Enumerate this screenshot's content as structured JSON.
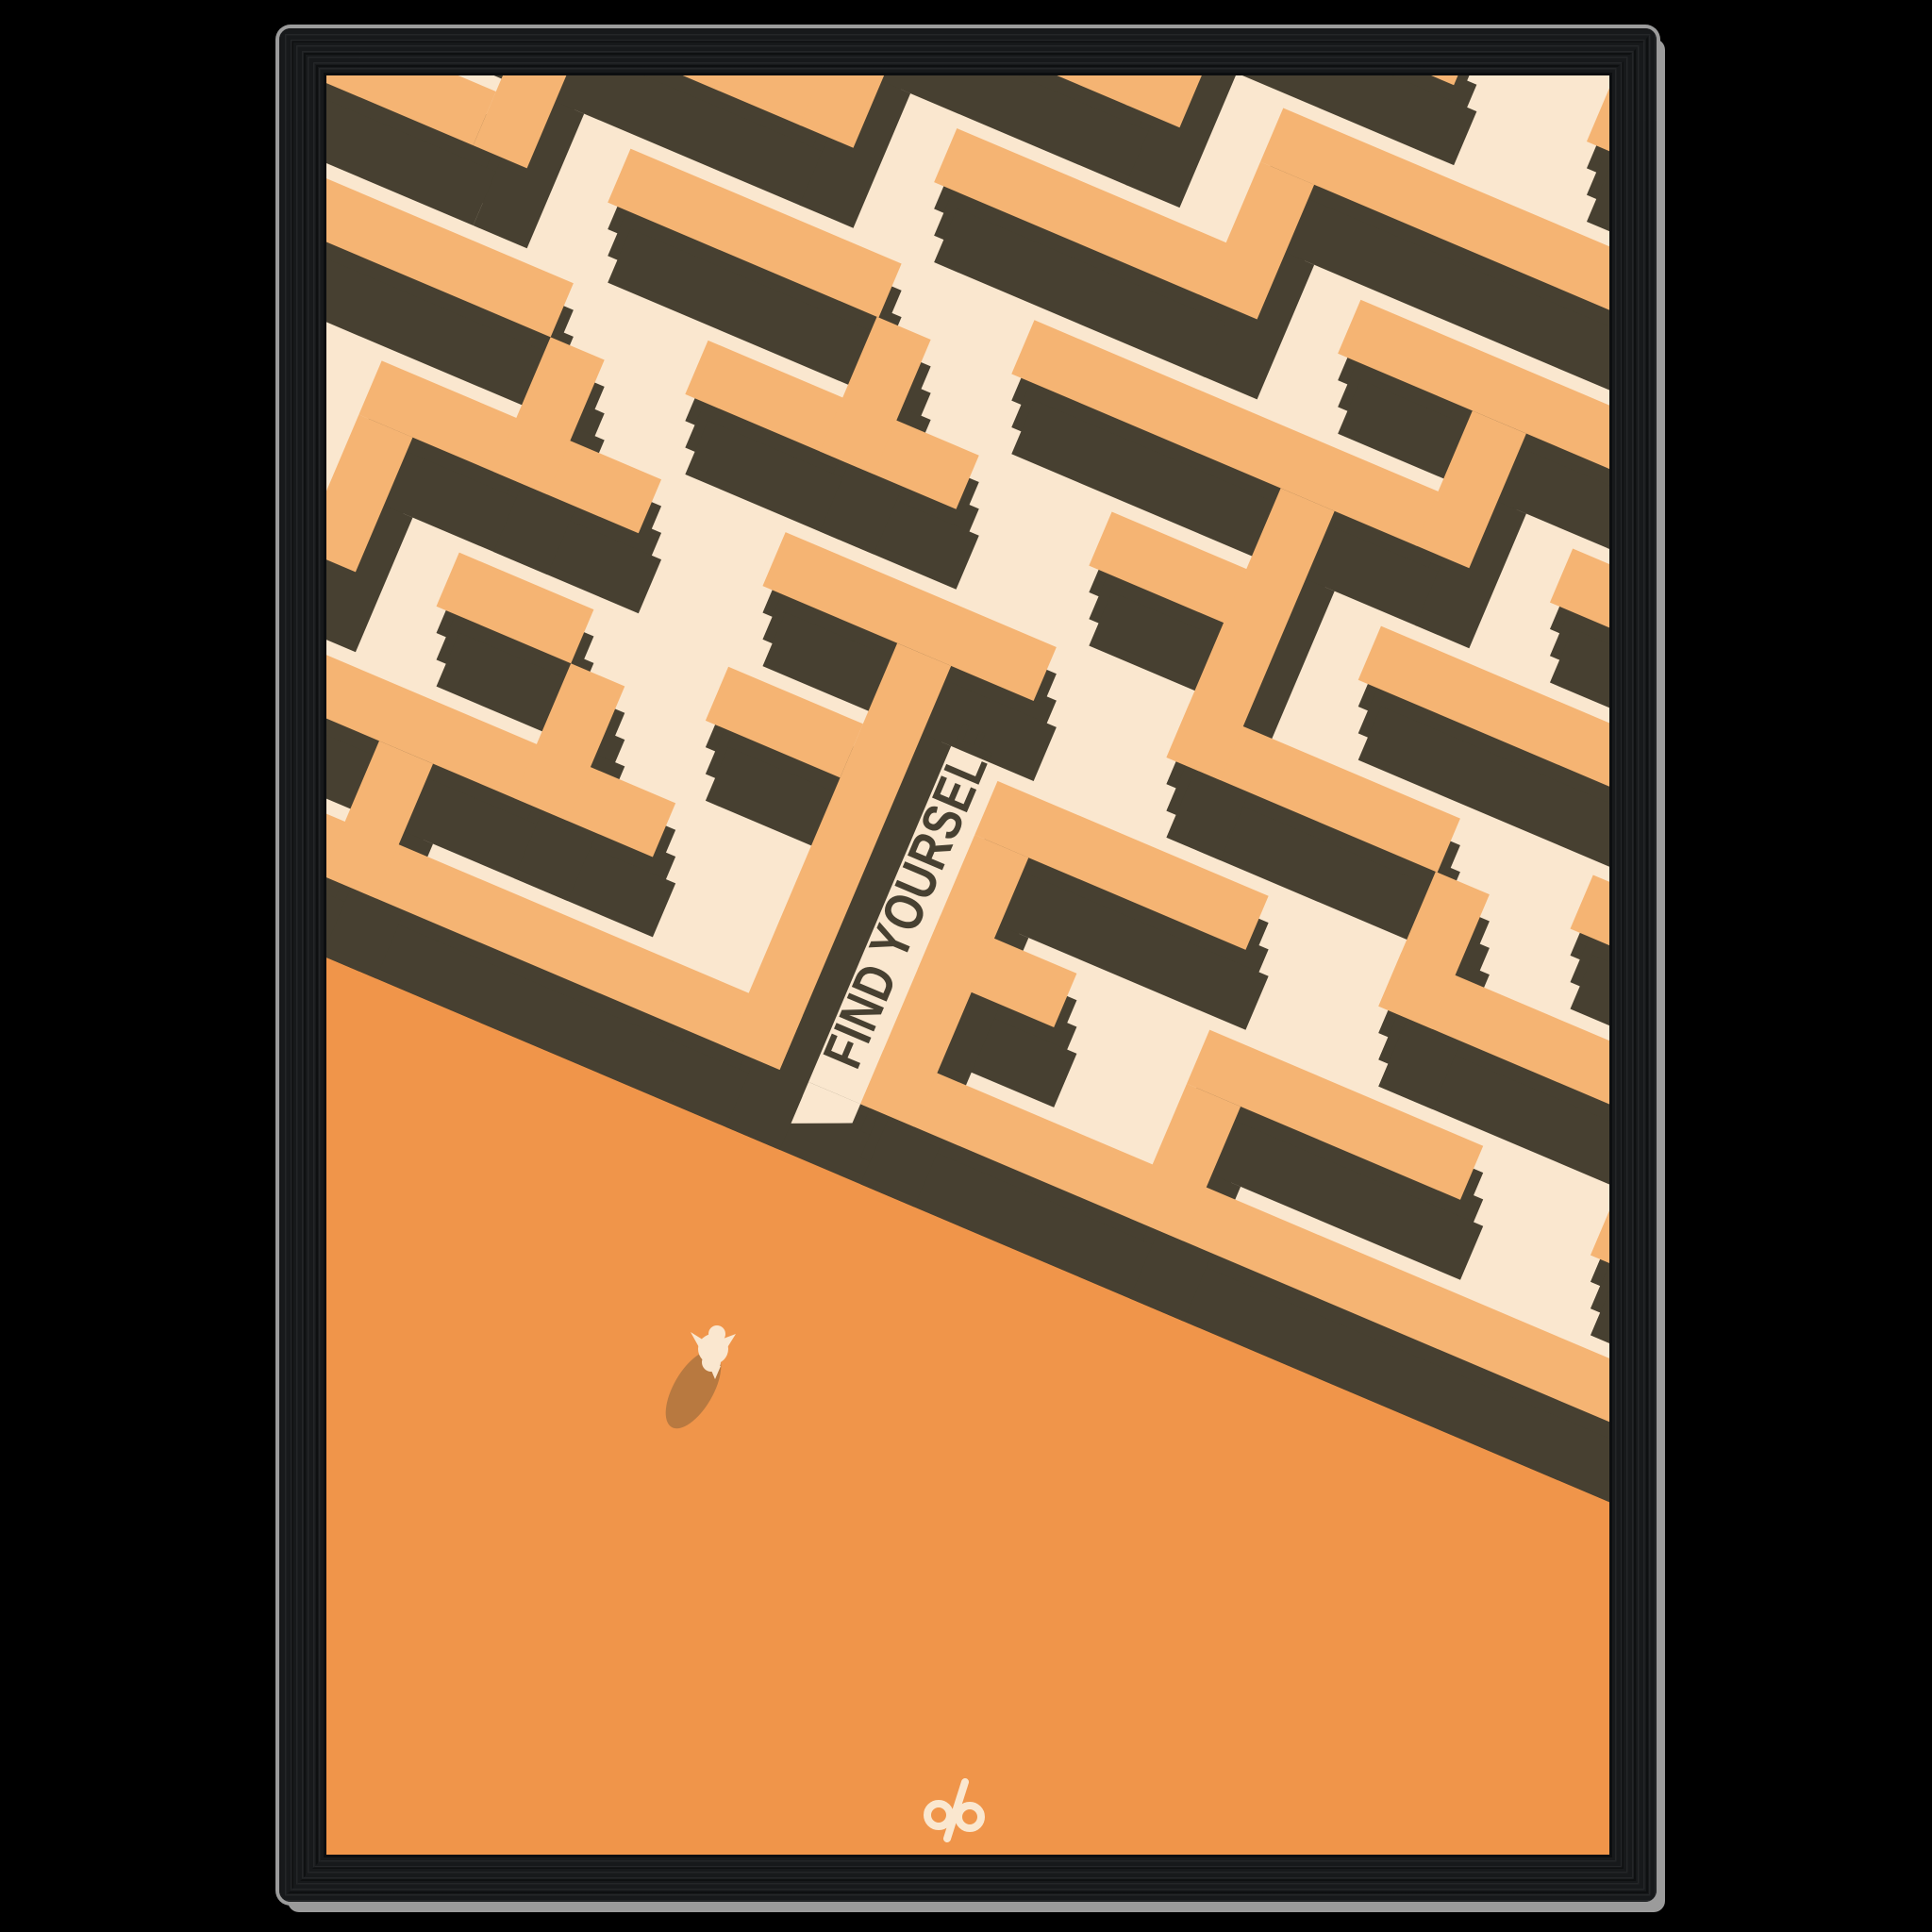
{
  "poster": {
    "headline": "FIND YOURSELF",
    "brand_mark": "dp"
  },
  "colors": {
    "page-bg": "#000000",
    "frame-wood": "#17191b",
    "frame-wood-dark": "#0c0e10",
    "frame-shadow": "#9b9b9b",
    "maze-floor": "#fae7cf",
    "maze-wall-top": "#f5b473",
    "maze-wall-side": "#474031",
    "ground": "#f0954a",
    "figure-body": "#fae7cf",
    "figure-shadow": "#b87940"
  }
}
